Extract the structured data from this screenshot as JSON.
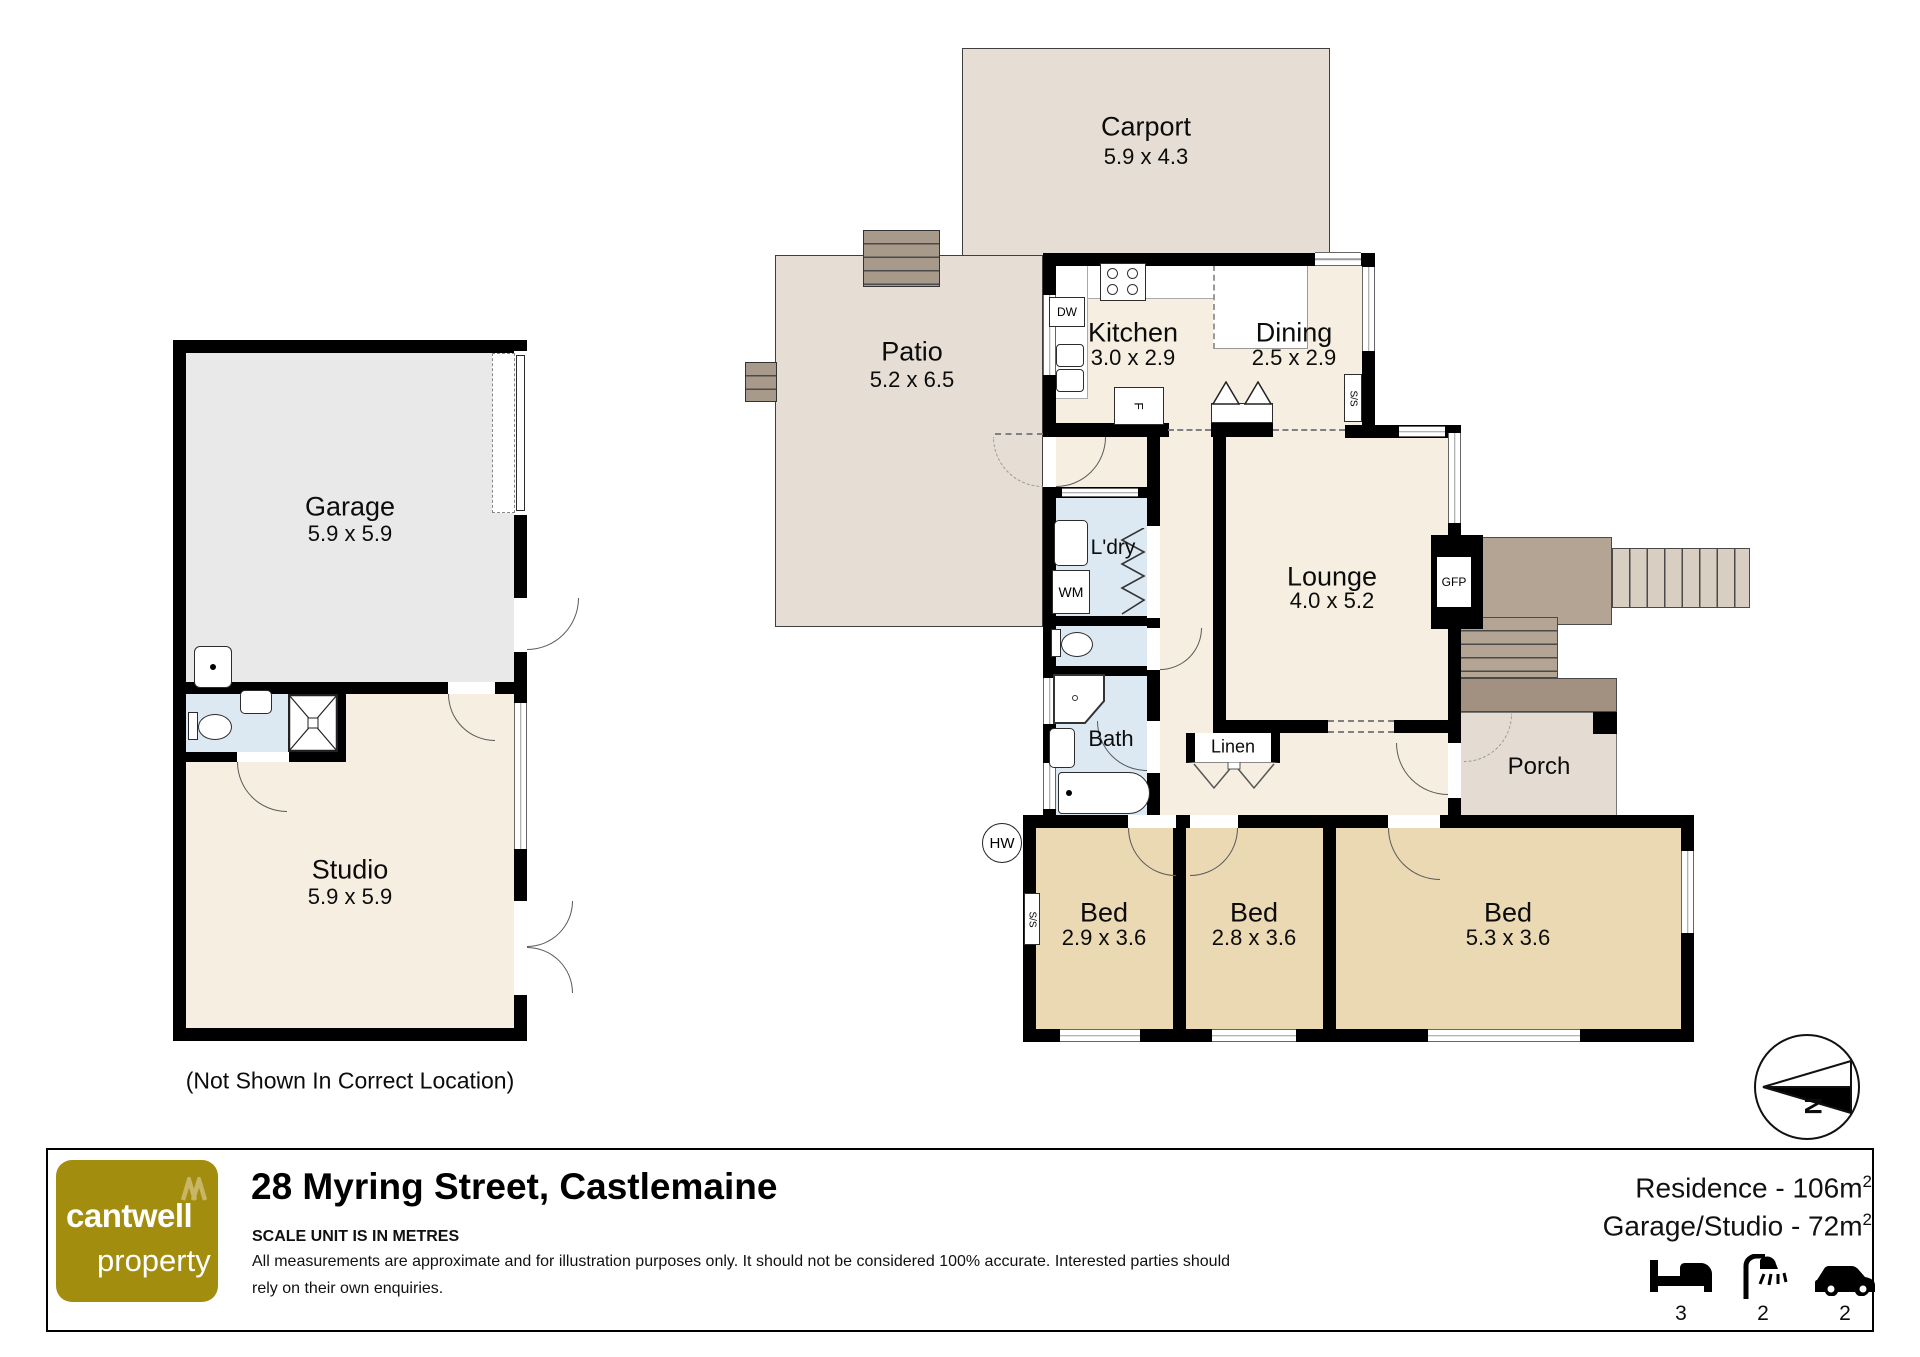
{
  "plan": {
    "rooms": {
      "carport": {
        "name": "Carport",
        "dims": "5.9 x 4.3"
      },
      "patio": {
        "name": "Patio",
        "dims": "5.2 x 6.5"
      },
      "kitchen": {
        "name": "Kitchen",
        "dims": "3.0 x 2.9"
      },
      "dining": {
        "name": "Dining",
        "dims": "2.5 x 2.9"
      },
      "lounge": {
        "name": "Lounge",
        "dims": "4.0 x 5.2"
      },
      "laundry": {
        "name": "L'dry"
      },
      "bath": {
        "name": "Bath"
      },
      "linen": {
        "name": "Linen"
      },
      "porch": {
        "name": "Porch"
      },
      "bed1": {
        "name": "Bed",
        "dims": "2.9 x 3.6"
      },
      "bed2": {
        "name": "Bed",
        "dims": "2.8 x 3.6"
      },
      "bed3": {
        "name": "Bed",
        "dims": "5.3 x 3.6"
      },
      "garage": {
        "name": "Garage",
        "dims": "5.9 x 5.9"
      },
      "studio": {
        "name": "Studio",
        "dims": "5.9 x 5.9"
      }
    },
    "fixtures": {
      "hw": "HW",
      "wm": "WM",
      "dw": "DW",
      "fridge": "F",
      "gfp": "GFP",
      "ss": "S/S"
    },
    "compass": {
      "north": "N"
    },
    "note": "(Not Shown In Correct Location)"
  },
  "footer": {
    "brand": {
      "line1": "cantwell",
      "line2": "property"
    },
    "title": "28 Myring Street, Castlemaine",
    "scale_note": "SCALE UNIT IS IN METRES",
    "disclaimer_line1": "All measurements are approximate and for illustration purposes only. It should not be considered 100% accurate. Interested parties should",
    "disclaimer_line2": "rely on their own enquiries.",
    "areas": {
      "residence": {
        "text": "Residence - 106m",
        "sup": "2"
      },
      "garage_studio": {
        "text": "Garage/Studio - 72m",
        "sup": "2"
      }
    },
    "counts": {
      "beds": "3",
      "baths": "2",
      "cars": "2"
    }
  },
  "colors": {
    "wall": "#000000",
    "outdoor": "#e6ded5",
    "residence": "#f6efe1",
    "bedrooms": "#ead9b2",
    "wet_areas": "#dde9f2",
    "garage": "#e9e9e9",
    "deck": "#b3a494",
    "brand_gold": "#a28d0f"
  }
}
